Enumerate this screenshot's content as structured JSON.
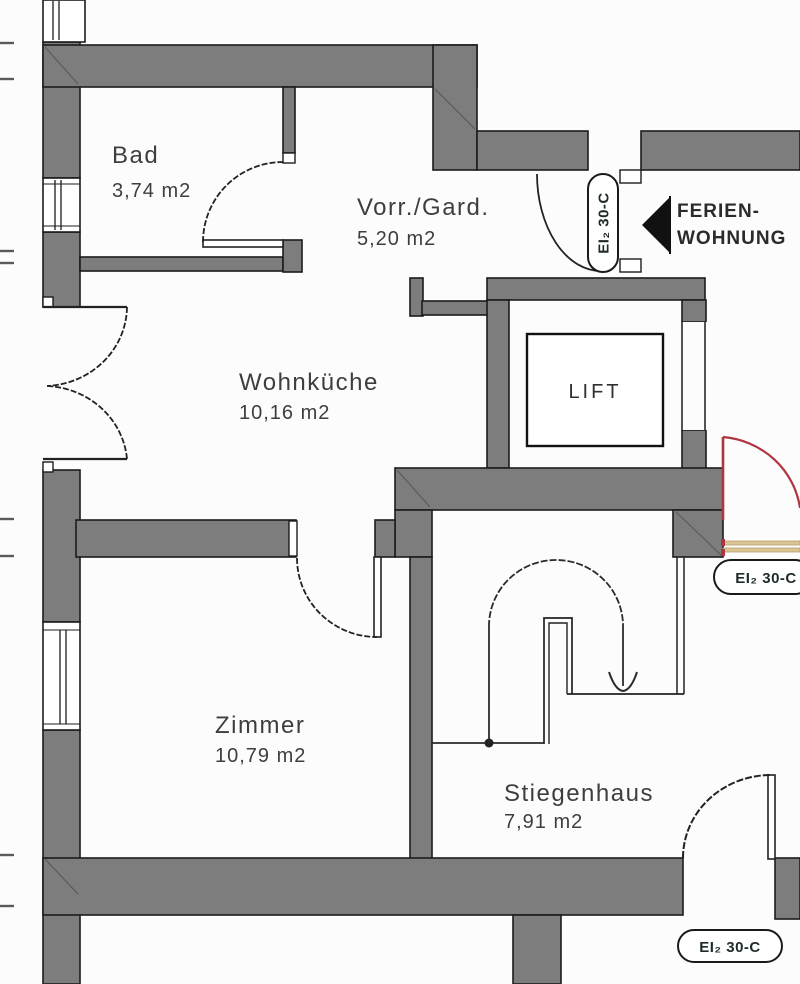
{
  "drawing": {
    "kind": "architectural floor plan (scan)",
    "language": "German"
  },
  "rooms": [
    {
      "key": "bad",
      "name": "Bad",
      "area": "3,74 m2"
    },
    {
      "key": "vorraum",
      "name": "Vorr./Gard.",
      "area": "5,20 m2"
    },
    {
      "key": "wohnkueche",
      "name": "Wohnküche",
      "area": "10,16 m2"
    },
    {
      "key": "zimmer",
      "name": "Zimmer",
      "area": "10,79 m2"
    },
    {
      "key": "stiegenhaus",
      "name": "Stiegenhaus",
      "area": "7,91 m2"
    }
  ],
  "lift": {
    "label": "LIFT"
  },
  "arrow_annotation": {
    "line1": "FERIEN-",
    "line2": "WOHNUNG"
  },
  "door_rating_labels": {
    "text": "EI₂ 30-C",
    "count": 3
  },
  "colors": {
    "wall_fill": "#7d7d7d",
    "line": "#1c1c1c",
    "entrance_door_red": "#b03540",
    "threshold_tan": "#d9c493",
    "background": "#fcfcfc"
  }
}
